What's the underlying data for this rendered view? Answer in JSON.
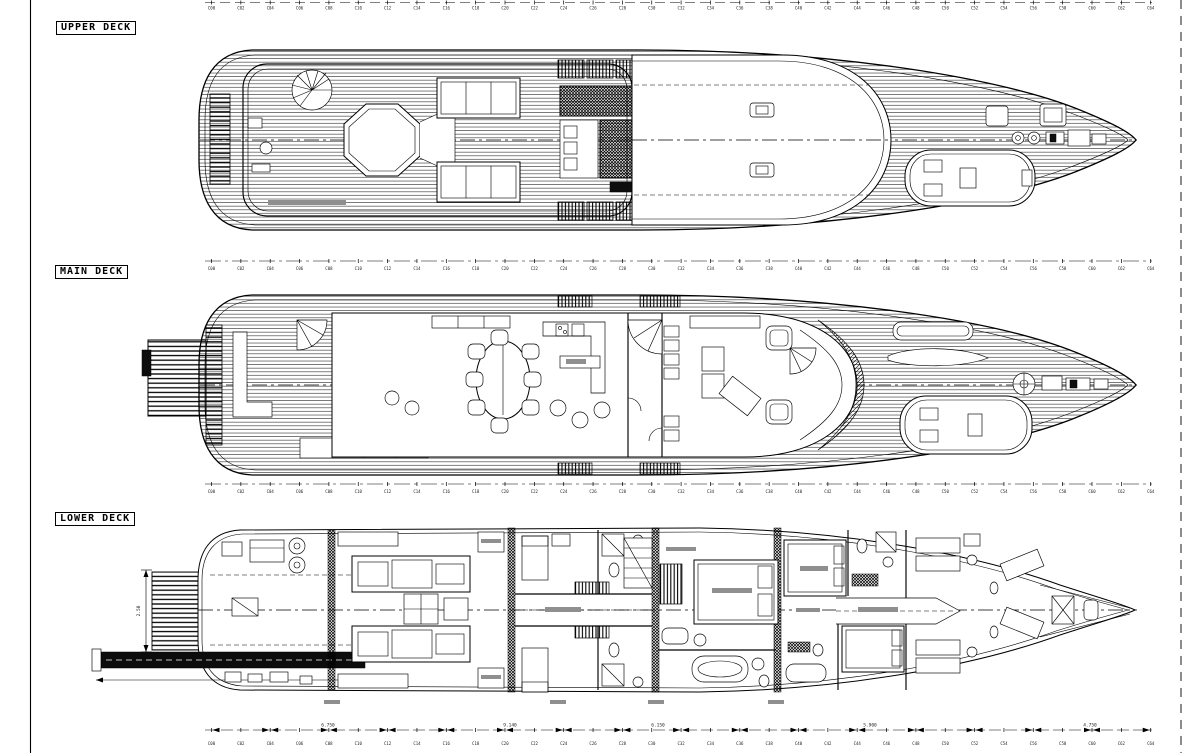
{
  "decks": {
    "upper": {
      "label": "UPPER DECK"
    },
    "main": {
      "label": "MAIN DECK"
    },
    "lower": {
      "label": "LOWER DECK"
    }
  },
  "rulers": {
    "stations": [
      "C00",
      "C02",
      "C04",
      "C06",
      "C08",
      "C10",
      "C12",
      "C14",
      "C16",
      "C18",
      "C20",
      "C22",
      "C24",
      "C26",
      "C28",
      "C30",
      "C32",
      "C34",
      "C36",
      "C38",
      "C40",
      "C42",
      "C44",
      "C46",
      "C48",
      "C50",
      "C52",
      "C54",
      "C56",
      "C58",
      "C60",
      "C62",
      "C64"
    ]
  },
  "dimensions": {
    "bottom": [
      "6.750",
      "9.140",
      "6.150",
      "5.900",
      "4.750"
    ],
    "platform_height": "2.50"
  }
}
